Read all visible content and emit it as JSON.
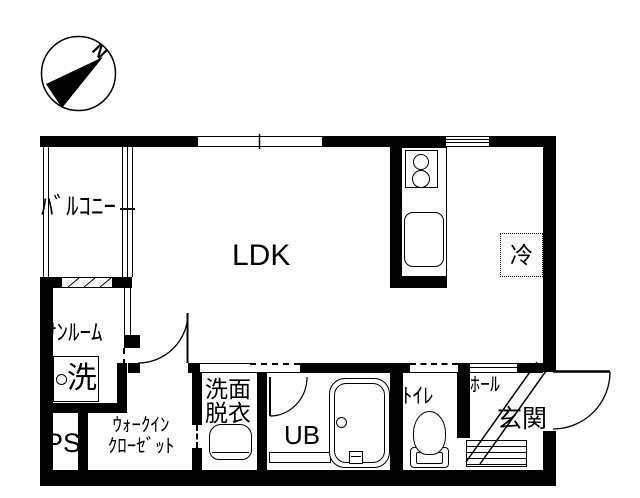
{
  "rooms": {
    "ldk": {
      "label": "LDK"
    },
    "balcony": {
      "label": "ﾊﾞﾙｺﾆｰ"
    },
    "sunroom": {
      "label": "ｻﾝﾙｰﾑ"
    },
    "laundry": {
      "label": "洗"
    },
    "pipe_space": {
      "label": "PS"
    },
    "walk_in_closet": {
      "label_line1": "ｳｫｰｸｲﾝ",
      "label_line2": "ｸﾛｰｾﾞｯﾄ"
    },
    "washroom": {
      "label_line1": "洗面",
      "label_line2": "脱衣"
    },
    "unit_bath": {
      "label": "UB"
    },
    "toilet": {
      "label": "ﾄｲﾚ"
    },
    "hall": {
      "label": "ﾎｰﾙ"
    },
    "entrance": {
      "label": "玄関"
    },
    "refrigerator": {
      "label": "冷"
    }
  },
  "compass": {
    "north_label": "N"
  },
  "colors": {
    "line": "#000000",
    "background": "#ffffff"
  }
}
